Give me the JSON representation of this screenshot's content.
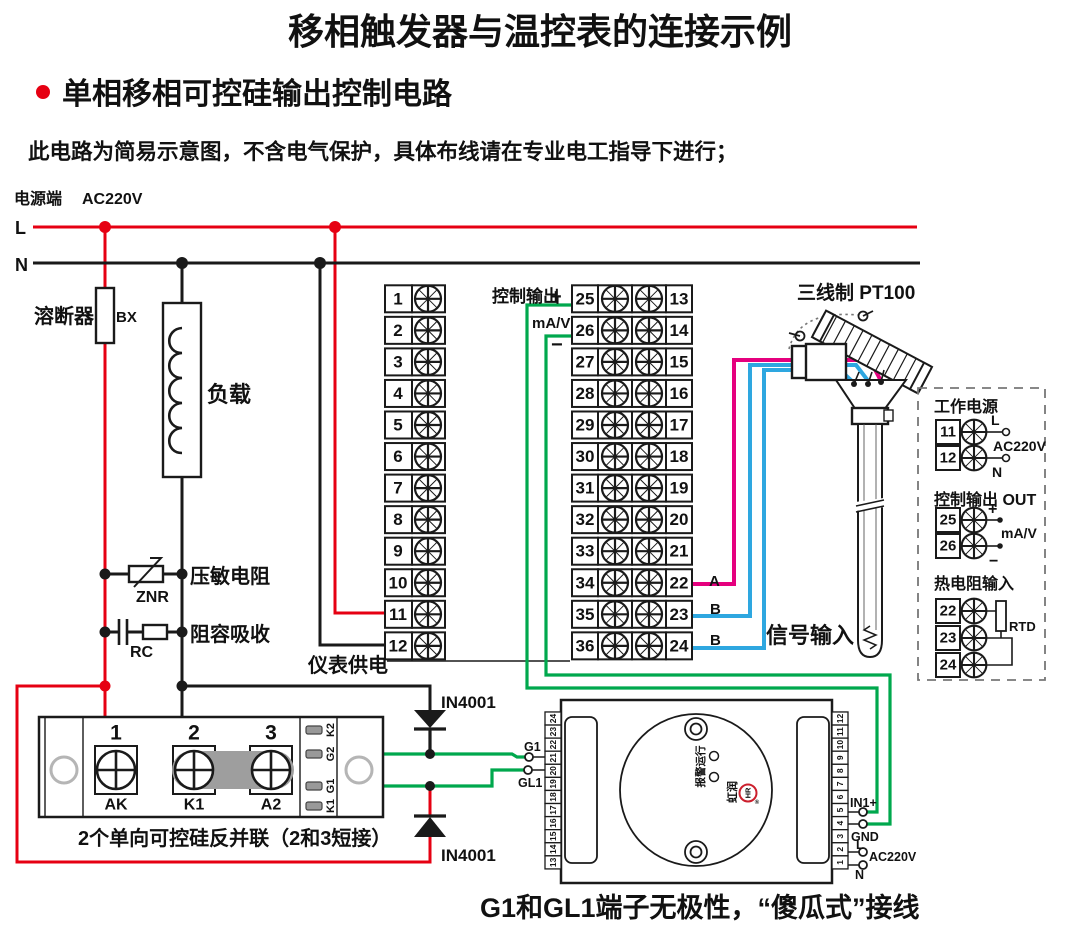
{
  "title": "移相触发器与温控表的连接示例",
  "subtitle": "单相移相可控硅输出控制电路",
  "note": "此电路为简易示意图，不含电气保护，具体布线请在专业电工指导下进行；",
  "power": {
    "source_label": "电源端",
    "voltage": "AC220V",
    "l": "L",
    "n": "N"
  },
  "left_components": {
    "fuse_name": "溶断器",
    "fuse_code": "BX",
    "load": "负载",
    "varistor_name": "压敏电阻",
    "varistor_code": "ZNR",
    "rc_name": "阻容吸收",
    "rc_code": "RC"
  },
  "meter": {
    "supply_label": "仪表供电",
    "ctrl_label": "控制输出",
    "plus": "+",
    "mav": "mA/V",
    "minus": "−",
    "signal_label": "信号输入",
    "wire_a": "A",
    "wire_b1": "B",
    "wire_b2": "B",
    "left_terminals": [
      "1",
      "2",
      "3",
      "4",
      "5",
      "6",
      "7",
      "8",
      "9",
      "10",
      "11",
      "12"
    ],
    "mid_terminals": [
      "25",
      "26",
      "27",
      "28",
      "29",
      "30",
      "31",
      "32",
      "33",
      "34",
      "35",
      "36"
    ],
    "right_terminals": [
      "13",
      "14",
      "15",
      "16",
      "17",
      "18",
      "19",
      "20",
      "21",
      "22",
      "23",
      "24"
    ]
  },
  "sensor": {
    "label": "三线制 PT100"
  },
  "panel": {
    "power_title": "工作电源",
    "t11": "11",
    "t12": "12",
    "l": "L",
    "n": "N",
    "voltage": "AC220V",
    "out_title": "控制输出 OUT",
    "t25": "25",
    "t26": "26",
    "plus": "+",
    "mav": "mA/V",
    "minus": "−",
    "rtd_title": "热电阻输入",
    "t22": "22",
    "t23": "23",
    "t24": "24",
    "rtd": "RTD"
  },
  "scr": {
    "n1": "1",
    "n2": "2",
    "n3": "3",
    "ak": "AK",
    "k1": "K1",
    "a2": "A2",
    "slots": [
      "K2",
      "G2",
      "G1",
      "K1"
    ],
    "caption": "2个单向可控硅反并联（2和3短接）"
  },
  "diodes": {
    "top": "IN4001",
    "bottom": "IN4001"
  },
  "trigger": {
    "left_terminals": [
      "24",
      "23",
      "22",
      "21",
      "20",
      "19",
      "18",
      "17",
      "16",
      "15",
      "14",
      "13"
    ],
    "right_terminals": [
      "12",
      "11",
      "10",
      "9",
      "8",
      "7",
      "6",
      "5",
      "4",
      "3",
      "2",
      "1"
    ],
    "g1": "G1",
    "gl1": "GL1",
    "in1": "IN1+",
    "gnd": "GND",
    "l": "L",
    "voltage": "AC220V",
    "n": "N",
    "run": "运行",
    "alarm": "报警",
    "brand": "虹润",
    "brand_mark": "HR",
    "reg": "®"
  },
  "bottom_note": "G1和GL1端子无极性，“傻瓜式”接线",
  "colors": {
    "red": "#e60012",
    "green": "#00a84d",
    "pink": "#e5007e",
    "blue": "#2ea7e0",
    "gray": "#9b9b9b"
  }
}
